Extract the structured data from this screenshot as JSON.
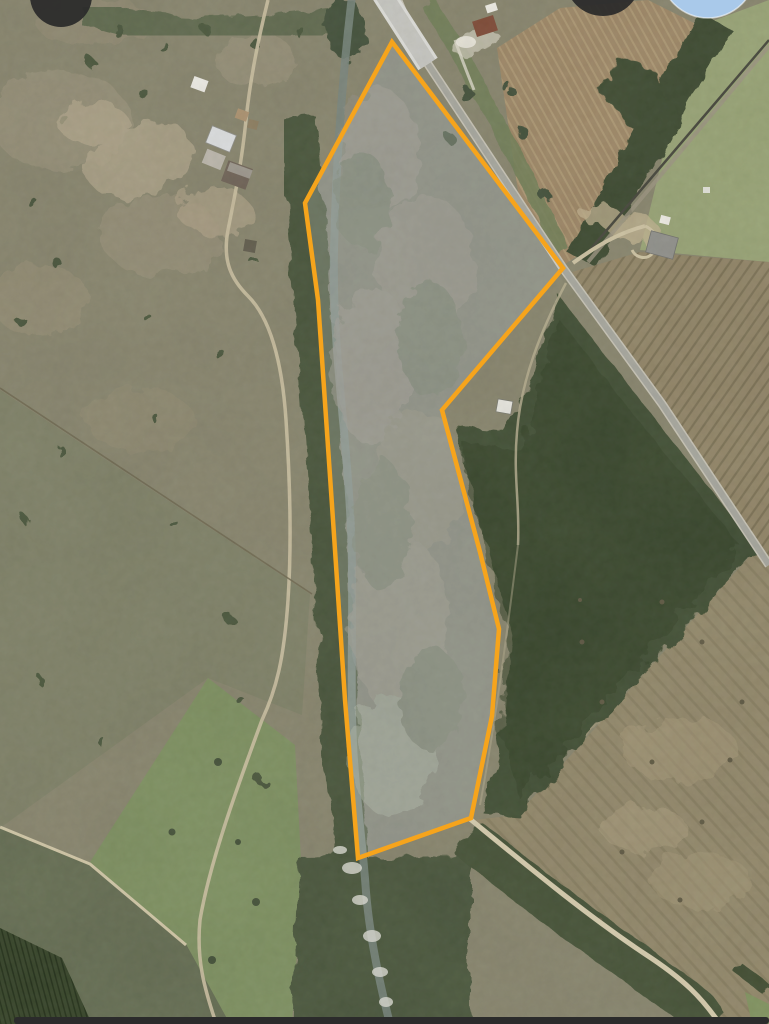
{
  "app": {
    "view": "satellite-map",
    "description": "Aerial imagery with highlighted land parcel boundary"
  },
  "parcel": {
    "stroke_color": "#F6A41C",
    "fill_color": "rgba(255,255,255,0.18)",
    "stroke_width": 4.5,
    "vertices": [
      [
        392,
        42
      ],
      [
        563,
        268
      ],
      [
        442,
        410
      ],
      [
        480,
        552
      ],
      [
        499,
        629
      ],
      [
        492,
        716
      ],
      [
        471,
        818
      ],
      [
        358,
        858
      ],
      [
        345,
        700
      ],
      [
        333,
        520
      ],
      [
        318,
        300
      ],
      [
        305,
        203
      ]
    ]
  },
  "ui": {
    "top_left_button": {
      "name": "map-control-button-left",
      "color": "rgba(42,42,42,0.93)"
    },
    "top_right_button": {
      "name": "map-control-button-right",
      "color": "rgba(42,42,42,0.93)"
    },
    "location_button": {
      "name": "location-button",
      "color": "#a9c9ea",
      "ring_color": "rgba(255,255,255,0.55)"
    },
    "bottom_bar": {
      "name": "bottom-sheet-edge",
      "color": "#2b2b2b"
    }
  },
  "map_features": {
    "roads": [
      "main-road",
      "bridge",
      "railroad",
      "farm-driveway",
      "bottom-right-road",
      "farm-track",
      "perimeter-trail"
    ],
    "water": [
      "creek"
    ],
    "vegetation": [
      "riparian-trees",
      "forest",
      "hedgerow",
      "pasture",
      "scrub-fields",
      "row-crops"
    ],
    "structures": [
      "farm-buildings-west",
      "farmhouse-north",
      "farmstead-east",
      "shed-at-notch"
    ]
  }
}
